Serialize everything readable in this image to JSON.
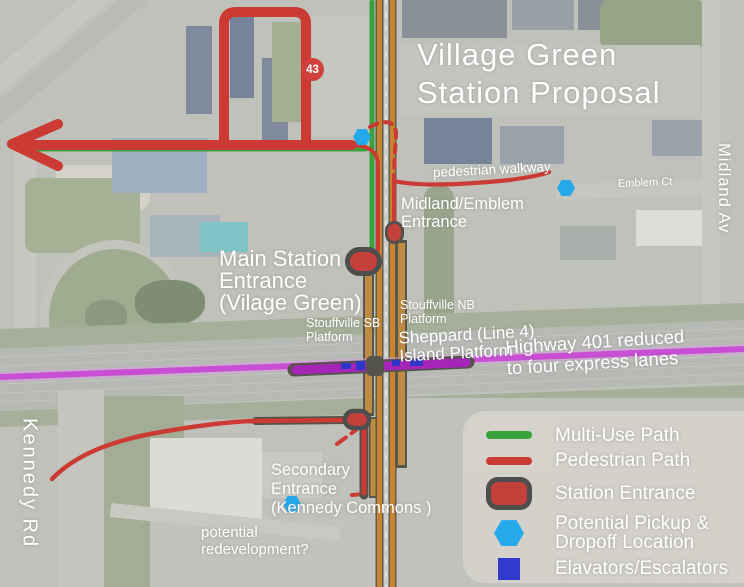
{
  "title": "Village Green\nStation Proposal",
  "map_labels": {
    "pedestrian_walkway": "pedestrian walkway",
    "emblem_ct": "Emblem Ct",
    "midland_av": "Midland Av",
    "kennedy_rd": "Kennedy Rd",
    "midland_emblem_entrance": "Midland/Emblem\nEntrance",
    "main_station_entrance": "Main Station\nEntrance\n(Vilage Green)",
    "stouffville_nb_platform": "Stouffville NB\nPlatform",
    "stouffville_sb_platform": "Stouffville SB\nPlatform",
    "sheppard_island_platform": "Sheppard (Line 4)\nIsland Platform",
    "highway_401": "Highway 401 reduced\nto four express lanes",
    "secondary_entrance": "Secondary\nEntrance\n(Kennedy Commons )",
    "potential_redevelopment": "potential\nredevelopment?",
    "route_badge": "43"
  },
  "legend": {
    "items": [
      {
        "label": "Multi-Use Path",
        "symbol": "multi-use-path-line",
        "color": "#3aa23c"
      },
      {
        "label": "Pedestrian Path",
        "symbol": "pedestrian-path-line",
        "color": "#cb3a33"
      },
      {
        "label": "Station Entrance",
        "symbol": "station-entrance-marker",
        "color": "#c4403a"
      },
      {
        "label": "Potential Pickup &\nDropoff Location",
        "symbol": "pickup-dropoff-hexagon",
        "color": "#25a9ea"
      },
      {
        "label": "Elavators/Escalators",
        "symbol": "elevator-square",
        "color": "#3239cd"
      }
    ]
  },
  "colors": {
    "multi_use_path": "#3aa23c",
    "pedestrian_path": "#cb3a33",
    "station_entrance_fill": "#c4403a",
    "station_entrance_outline": "#4e4e4e",
    "pickup_hexagon": "#25a9ea",
    "elevator_square": "#2e36c8",
    "rail_line": "#c9842c",
    "platform": "#bf8a41",
    "highway_401_line": "#c84fd4",
    "island_platform": "#a625b8",
    "route_badge": "#d0413c",
    "label_text": "#ffffff",
    "legend_background": "#d5d2cc"
  }
}
